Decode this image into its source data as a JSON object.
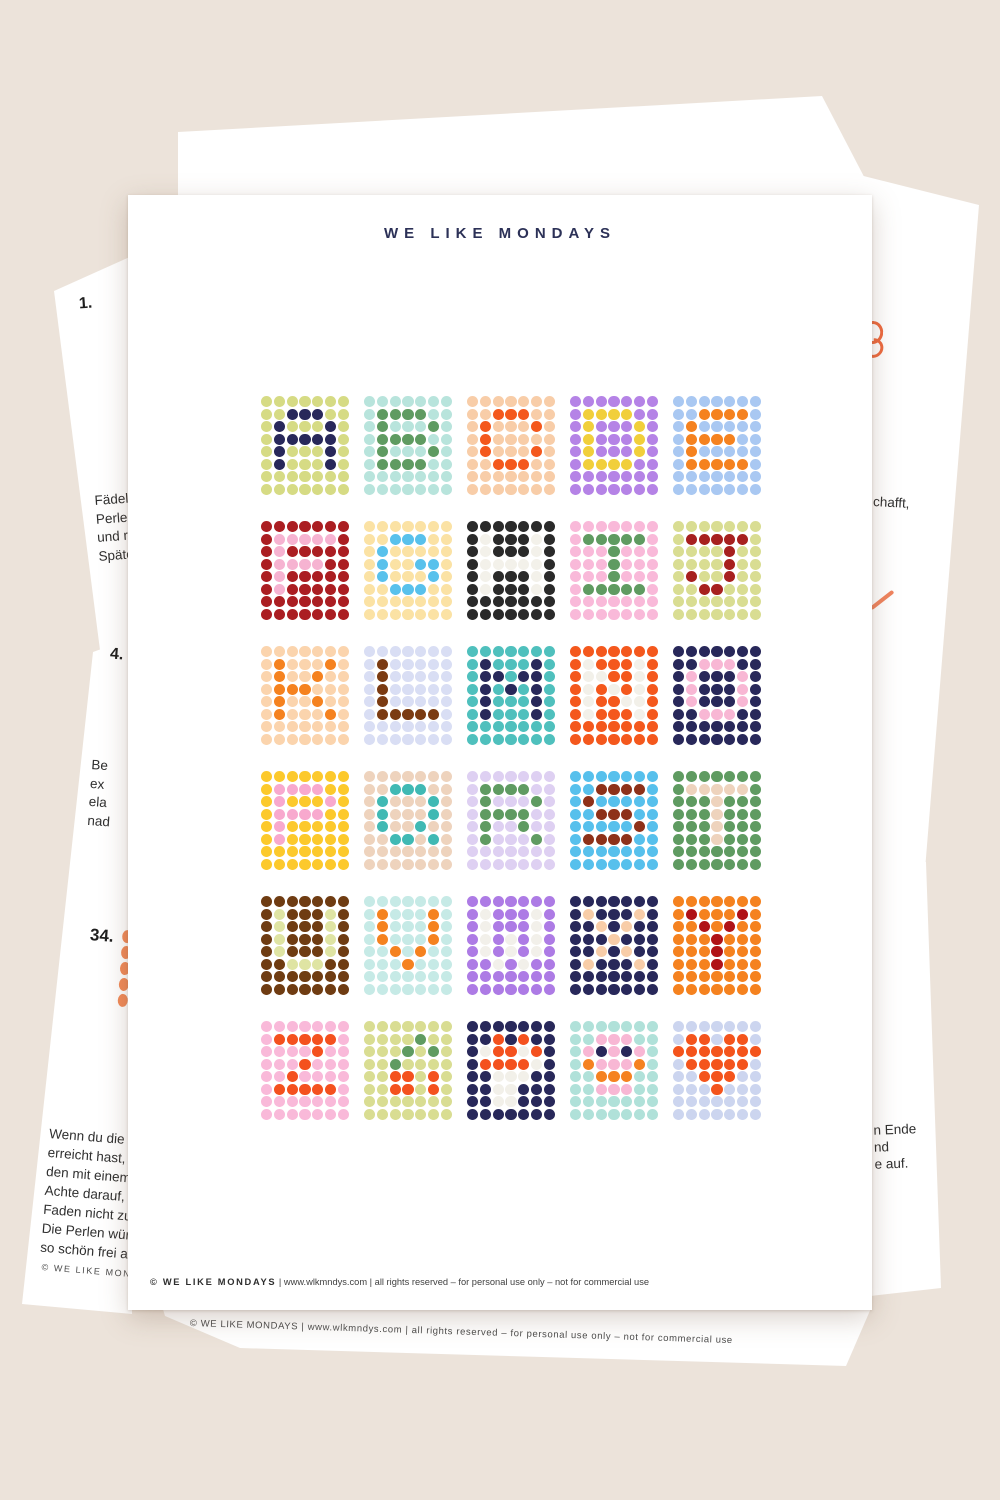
{
  "background": "#ece3da",
  "top_page": {
    "title": "WE LIKE MONDAYS",
    "title_color": "#2c3157",
    "footer": {
      "brand": "© WE LIKE MONDAYS",
      "rest": " | www.wlkmndys.com | all rights reserved – for personal use only – not for commercial use"
    }
  },
  "bead_tiles": [
    {
      "label": "A",
      "bg": "#d6db84",
      "fg": "#28285a",
      "pattern": [
        ".XXX.",
        "X...X",
        "XXXXX",
        "X...X",
        "X...X"
      ]
    },
    {
      "label": "B",
      "bg": "#b8e4dc",
      "fg": "#5f9b61",
      "pattern": [
        "XXXX.",
        "X...X",
        "XXXX.",
        "X...X",
        "XXXX."
      ]
    },
    {
      "label": "C",
      "bg": "#f8cda8",
      "fg": "#f4581d",
      "pattern": [
        ".XXX.",
        "X...X",
        "X....",
        "X...X",
        ".XXX."
      ]
    },
    {
      "label": "D",
      "bg": "#b583e6",
      "fg": "#f1cf3b",
      "pattern": [
        "XXXX.",
        "X...X",
        "X...X",
        "X...X",
        "XXXX."
      ]
    },
    {
      "label": "E",
      "bg": "#a9c8f2",
      "fg": "#f5821f",
      "pattern": [
        ".XXXX",
        "X....",
        "XXXX.",
        "X....",
        "XXXXX"
      ]
    },
    {
      "label": "F",
      "bg": "#ab1e22",
      "fg": "#f6b3d1",
      "pattern": [
        "XXXXX",
        "X....",
        "XXXX.",
        "X....",
        "X...."
      ]
    },
    {
      "label": "G",
      "bg": "#fbe2a4",
      "fg": "#58c1ec",
      "pattern": [
        ".XXX.",
        "X....",
        "X..XX",
        "X...X",
        ".XXX."
      ]
    },
    {
      "label": "H",
      "bg": "#2a2a2a",
      "fg": "#f3f1ea",
      "pattern": [
        "X...X",
        "X...X",
        "XXXXX",
        "X...X",
        "X...X"
      ]
    },
    {
      "label": "I",
      "bg": "#f9b9d9",
      "fg": "#5f9b61",
      "pattern": [
        "XXXXX",
        "..X..",
        "..X..",
        "..X..",
        "XXXXX"
      ]
    },
    {
      "label": "J",
      "bg": "#d9dd92",
      "fg": "#a7201f",
      "pattern": [
        "XXXXX",
        "...X.",
        "...X.",
        "X..X.",
        ".XX.."
      ]
    },
    {
      "label": "K",
      "bg": "#fbd4ad",
      "fg": "#f5821f",
      "pattern": [
        "X...X",
        "X..X.",
        "XXX..",
        "X..X.",
        "X...X"
      ]
    },
    {
      "label": "L",
      "bg": "#d9def4",
      "fg": "#7b3b12",
      "pattern": [
        "X....",
        "X....",
        "X....",
        "X....",
        "XXXXX"
      ]
    },
    {
      "label": "M",
      "bg": "#4fc0bd",
      "fg": "#28285a",
      "pattern": [
        "X...X",
        "XX.XX",
        "X.X.X",
        "X...X",
        "X...X"
      ]
    },
    {
      "label": "N",
      "bg": "#f4581d",
      "fg": "#f2f0e9",
      "pattern": [
        "X...X",
        "XX..X",
        "X.X.X",
        "X..XX",
        "X...X"
      ]
    },
    {
      "label": "O",
      "bg": "#28285a",
      "fg": "#f8b7d4",
      "pattern": [
        ".XXX.",
        "X...X",
        "X...X",
        "X...X",
        ".XXX."
      ]
    },
    {
      "label": "P",
      "bg": "#fcc92c",
      "fg": "#f8a9ce",
      "pattern": [
        "XXXX.",
        "X...X",
        "XXXX.",
        "X....",
        "X...."
      ]
    },
    {
      "label": "Q",
      "bg": "#eed3bd",
      "fg": "#40b9b4",
      "pattern": [
        ".XXX.",
        "X...X",
        "X...X",
        "X..X.",
        ".XX.X"
      ]
    },
    {
      "label": "R",
      "bg": "#ded0f2",
      "fg": "#5f9b61",
      "pattern": [
        "XXXX.",
        "X...X",
        "XXXX.",
        "X..X.",
        "X...X"
      ]
    },
    {
      "label": "S",
      "bg": "#57c0ec",
      "fg": "#8e3119",
      "pattern": [
        ".XXXX",
        "X....",
        ".XXX.",
        "....X",
        "XXXX."
      ]
    },
    {
      "label": "T",
      "bg": "#5f9b61",
      "fg": "#eed3bd",
      "pattern": [
        "XXXXX",
        "..X..",
        "..X..",
        "..X..",
        "..X.."
      ]
    },
    {
      "label": "U",
      "bg": "#6f3c12",
      "fg": "#dfe4a3",
      "pattern": [
        "X...X",
        "X...X",
        "X...X",
        "X...X",
        ".XXX."
      ]
    },
    {
      "label": "V",
      "bg": "#c6eae6",
      "fg": "#f5821f",
      "pattern": [
        "X...X",
        "X...X",
        "X...X",
        ".X.X.",
        "..X.."
      ]
    },
    {
      "label": "W",
      "bg": "#ad7be5",
      "fg": "#f2f0ea",
      "pattern": [
        "X...X",
        "X...X",
        "X.X.X",
        "X.X.X",
        ".X.X."
      ]
    },
    {
      "label": "X",
      "bg": "#28285a",
      "fg": "#f8cda8",
      "pattern": [
        "X...X",
        ".X.X.",
        "..X..",
        ".X.X.",
        "X...X"
      ]
    },
    {
      "label": "Y",
      "bg": "#f5821f",
      "fg": "#b01217",
      "pattern": [
        "X...X",
        ".X.X.",
        "..X..",
        "..X..",
        "..X.."
      ]
    },
    {
      "label": "Z",
      "bg": "#f9b9d9",
      "fg": "#f4511e",
      "pattern": [
        "XXXXX",
        "...X.",
        "..X..",
        ".X...",
        "XXXXX"
      ]
    },
    {
      "label": "cherries",
      "colors": {
        ".": "#d9dd92",
        "G": "#5f9b61",
        "O": "#f4511e"
      },
      "grid": [
        ".......",
        "....G..",
        "...G.G.",
        "..G....",
        "..OO.O.",
        "..OO.O.",
        ".......",
        "......."
      ]
    },
    {
      "label": "motif",
      "colors": {
        ".": "#28285a",
        "C": "#f2f0e9",
        "O": "#f4511e"
      },
      "grid": [
        ".......",
        "..O.O..",
        ".COOCO.",
        ".OOOOC.",
        "..CCC..",
        "..CC...",
        "..CC...",
        "......."
      ]
    },
    {
      "label": "smiley",
      "colors": {
        ".": "#b0e1d9",
        "P": "#f8b7d4",
        "N": "#28285a",
        "O": "#f58220"
      },
      "grid": [
        ".......",
        "..PPP..",
        ".PNPNP.",
        ".OPPPO.",
        "..OOO..",
        "..PPP..",
        ".......",
        "......."
      ]
    },
    {
      "label": "heart",
      "colors": {
        ".": "#ccd5ef",
        "O": "#f4541c"
      },
      "grid": [
        ".......",
        ".OO.OO.",
        "OOOOOOO",
        ".OOOOO.",
        "..OOO..",
        "...O...",
        ".......",
        "......."
      ]
    }
  ],
  "under": {
    "left_upper": {
      "number": "1.",
      "fragment1": [
        "Fädele",
        "Perle.",
        "und r",
        "Späte"
      ]
    },
    "left_lower": {
      "number4": "4.",
      "fragment2": [
        "Be",
        "ex",
        "ela",
        "nad"
      ],
      "number34": "34.",
      "paragraph": [
        "Wenn du die S",
        "erreicht hast,",
        "den mit einem",
        "Achte darauf, d",
        "Faden nicht zu",
        "Die Perlen würd",
        "so schön frei au"
      ],
      "footer": "© WE LIKE MON"
    },
    "right_upper": {
      "fragment": "chafft,"
    },
    "right_lower": {
      "lines": [
        "n Ende",
        "nd",
        "e auf."
      ]
    },
    "bottom": {
      "footer": "© WE LIKE MONDAYS | www.wlkmndys.com | all rights reserved – for personal use only – not for commercial use"
    }
  }
}
